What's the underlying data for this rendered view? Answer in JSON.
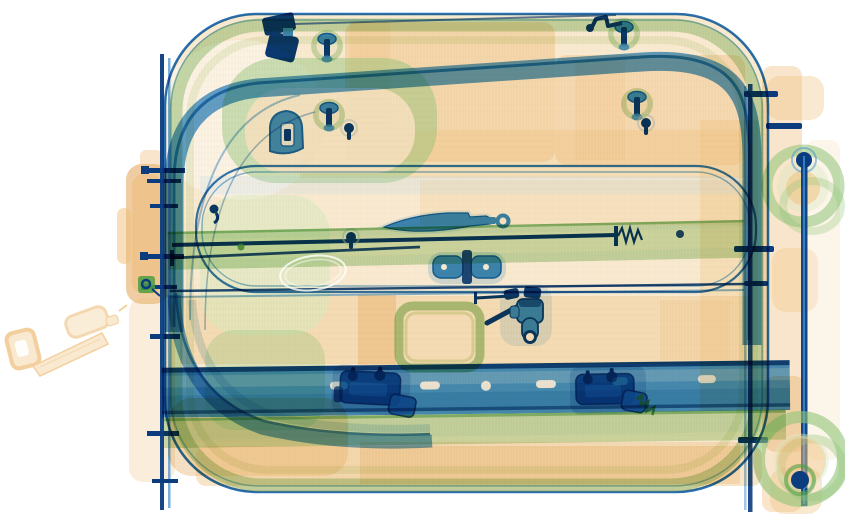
{
  "scene": {
    "type": "x-ray-baggage-scan",
    "subject": "Rolling carry-on suitcase, side view, dual-energy security X-ray",
    "material_legend": {
      "orange": "organic / low-density (fabric, leather, plastic shell, strap)",
      "green": "intermediate density (rubber wheels, reinforced trim, garment frame)",
      "blue": "metal / high-density (frame rails, rods, locks, zipper, knife blade)"
    },
    "objects": [
      {
        "name": "suitcase-shell",
        "material": "organic"
      },
      {
        "name": "lid-frame-band",
        "material": "metal"
      },
      {
        "name": "inner-compartment-frame",
        "material": "metal"
      },
      {
        "name": "support-rods",
        "material": "metal"
      },
      {
        "name": "pocket-knife-blade",
        "material": "metal"
      },
      {
        "name": "hinge-plates",
        "material": "metal"
      },
      {
        "name": "zipper-slider-and-pull",
        "material": "metal"
      },
      {
        "name": "latch-lock-left",
        "material": "metal"
      },
      {
        "name": "latch-lock-right",
        "material": "metal"
      },
      {
        "name": "coil-spring",
        "material": "metal"
      },
      {
        "name": "rivet-studs",
        "count": 4,
        "material": "metal"
      },
      {
        "name": "d-shaped-lock",
        "material": "metal"
      },
      {
        "name": "corner-bracket",
        "material": "metal"
      },
      {
        "name": "left-frame-rail",
        "material": "metal"
      },
      {
        "name": "telescopic-handle-tubes",
        "material": "metal"
      },
      {
        "name": "wheel-top",
        "material": "rubber"
      },
      {
        "name": "wheel-bottom",
        "material": "rubber"
      },
      {
        "name": "side-carry-handle",
        "material": "organic"
      },
      {
        "name": "external-strap-with-buckle",
        "material": "organic"
      },
      {
        "name": "garment-frame",
        "material": "intermediate"
      },
      {
        "name": "wire-loop",
        "material": "thin-metal"
      }
    ]
  },
  "palette": {
    "background": "#ffffff",
    "organic_pale": "#f7e2c0",
    "organic_mid": "#efbf7c",
    "organic_deep": "#e09a45",
    "fabric_pale": "#d9e9c0",
    "fabric_mid": "#8fc478",
    "fabric_deep": "#4f9e42",
    "metal_pale": "#aed4ee",
    "metal_mid": "#3d8fd1",
    "metal_deep": "#1261ad",
    "metal_navy": "#0a3c7e"
  }
}
